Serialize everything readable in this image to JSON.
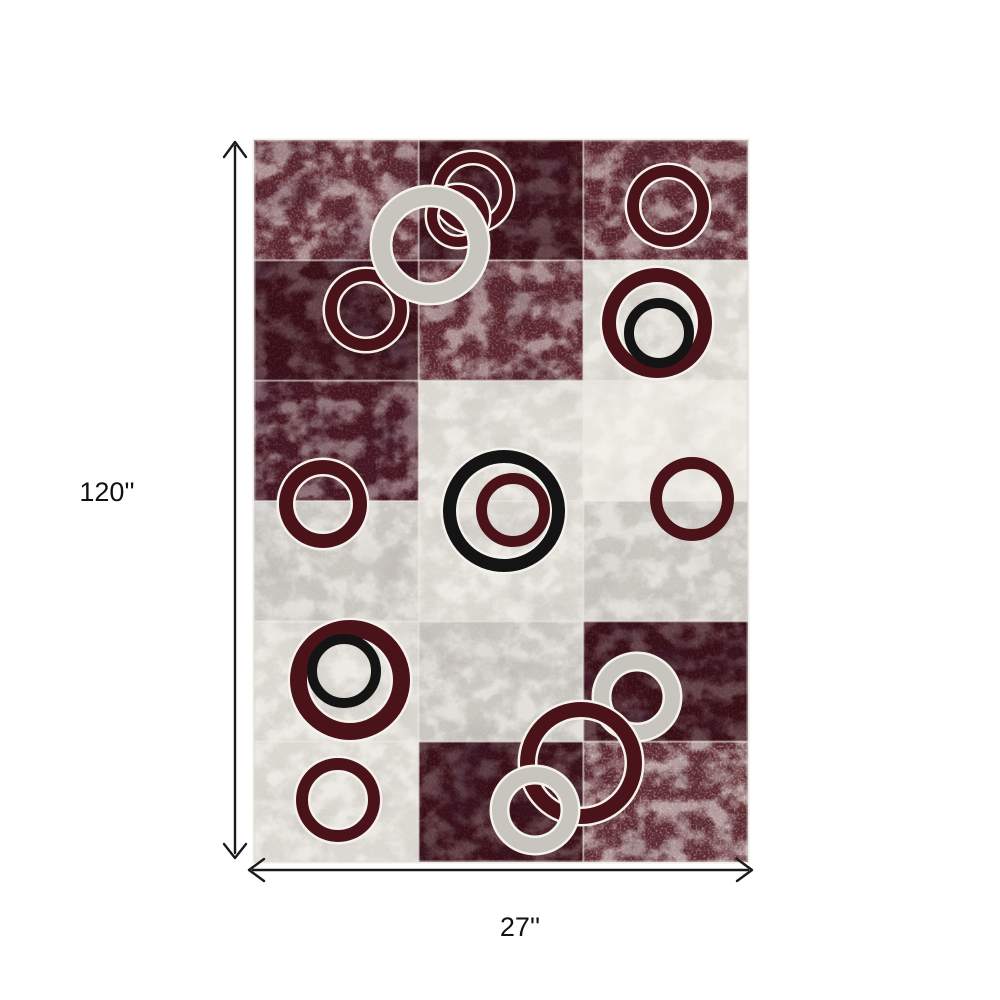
{
  "page": {
    "background_color": "#ffffff"
  },
  "annotations": {
    "height_label": "120''",
    "width_label": "27''",
    "arrow_color": "#1a1a1a",
    "label_color": "#111111"
  },
  "rug": {
    "x": 254,
    "y": 140,
    "width": 494,
    "height": 722,
    "columns": 3,
    "rows": 6,
    "palette": {
      "ring_burgundy": "#491319",
      "ring_black": "#141414",
      "ring_gray": "#c8c5be",
      "ring_outline": "#f4f2ec",
      "grid_line": "#ece9e2",
      "edge": "#ddd8d1"
    },
    "cell_styles": {
      "dark_burgundy": {
        "fill": "#380e15",
        "veins": 0.22,
        "speckle": 0.1,
        "patches": 0.55
      },
      "burgundy_marble": {
        "fill": "#5a242c",
        "veins": 0.5,
        "speckle": 0.3,
        "patches": 0.3
      },
      "burgundy_dark_marble": {
        "fill": "#451520",
        "veins": 0.4,
        "speckle": 0.15,
        "patches": 0.4
      },
      "burgundy_speckled": {
        "fill": "#5e2a31",
        "veins": 0.55,
        "speckle": 0.4,
        "patches": 0.2
      },
      "light_gray": {
        "fill": "#dbd8d1",
        "veins": 0.55,
        "speckle": 0.2,
        "patches": 0.07
      },
      "gray": {
        "fill": "#c9c6c0",
        "veins": 0.5,
        "speckle": 0.18,
        "patches": 0.08
      },
      "white_marble": {
        "fill": "#eae7e0",
        "veins": 0.45,
        "speckle": 0.12,
        "patches": 0.05
      }
    },
    "cells": [
      [
        "burgundy_marble",
        "dark_burgundy",
        "burgundy_marble"
      ],
      [
        "dark_burgundy",
        "burgundy_marble",
        "light_gray"
      ],
      [
        "burgundy_dark_marble",
        "light_gray",
        "white_marble"
      ],
      [
        "gray",
        "light_gray",
        "gray"
      ],
      [
        "light_gray",
        "gray",
        "dark_burgundy"
      ],
      [
        "light_gray",
        "dark_burgundy",
        "burgundy_speckled"
      ]
    ],
    "circles": [
      {
        "cx": 219,
        "cy": 52,
        "r": 40,
        "band": 11,
        "color": "ring_burgundy",
        "outline": true,
        "name": "top-middle-ring-large"
      },
      {
        "cx": 204,
        "cy": 76,
        "r": 31,
        "band": 10,
        "color": "ring_burgundy",
        "outline": true,
        "name": "top-middle-ring-small"
      },
      {
        "cx": 414,
        "cy": 66,
        "r": 41,
        "band": 12,
        "color": "ring_burgundy",
        "outline": true,
        "name": "top-right-ring"
      },
      {
        "cx": 112,
        "cy": 170,
        "r": 41,
        "band": 12,
        "color": "ring_burgundy",
        "outline": true,
        "name": "upper-left-ring"
      },
      {
        "cx": 176,
        "cy": 105,
        "r": 58,
        "band": 18,
        "color": "ring_gray",
        "outline": true,
        "name": "upper-gray-ring"
      },
      {
        "cx": 403,
        "cy": 183,
        "r": 55,
        "band": 14,
        "color": "ring_burgundy",
        "outline": true,
        "name": "upper-right-outer-ring"
      },
      {
        "cx": 405,
        "cy": 193,
        "r": 35,
        "band": 10,
        "color": "ring_black",
        "outline": false,
        "name": "upper-right-inner-black-ring"
      },
      {
        "cx": 69,
        "cy": 364,
        "r": 44,
        "band": 14,
        "color": "ring_burgundy",
        "outline": true,
        "name": "middle-left-ring"
      },
      {
        "cx": 250,
        "cy": 371,
        "r": 61,
        "band": 13,
        "color": "ring_black",
        "outline": true,
        "name": "center-black-ring"
      },
      {
        "cx": 259,
        "cy": 370,
        "r": 37,
        "band": 11,
        "color": "ring_burgundy",
        "outline": false,
        "name": "center-inner-burgundy-ring"
      },
      {
        "cx": 438,
        "cy": 359,
        "r": 42,
        "band": 12,
        "color": "ring_burgundy",
        "outline": false,
        "name": "middle-right-ring"
      },
      {
        "cx": 96,
        "cy": 540,
        "r": 60,
        "band": 17,
        "color": "ring_burgundy",
        "outline": true,
        "name": "lower-left-outer-ring"
      },
      {
        "cx": 90,
        "cy": 531,
        "r": 37,
        "band": 10,
        "color": "ring_black",
        "outline": false,
        "name": "lower-left-inner-black-ring"
      },
      {
        "cx": 84,
        "cy": 660,
        "r": 42,
        "band": 12,
        "color": "ring_burgundy",
        "outline": true,
        "name": "bottom-left-ring"
      },
      {
        "cx": 383,
        "cy": 557,
        "r": 43,
        "band": 15,
        "color": "ring_gray",
        "outline": true,
        "name": "bottom-cluster-gray-top-ring"
      },
      {
        "cx": 327,
        "cy": 623,
        "r": 61,
        "band": 15,
        "color": "ring_burgundy",
        "outline": true,
        "name": "bottom-cluster-burgundy-ring"
      },
      {
        "cx": 281,
        "cy": 670,
        "r": 43,
        "band": 15,
        "color": "ring_gray",
        "outline": true,
        "name": "bottom-cluster-gray-bottom-ring"
      }
    ]
  }
}
